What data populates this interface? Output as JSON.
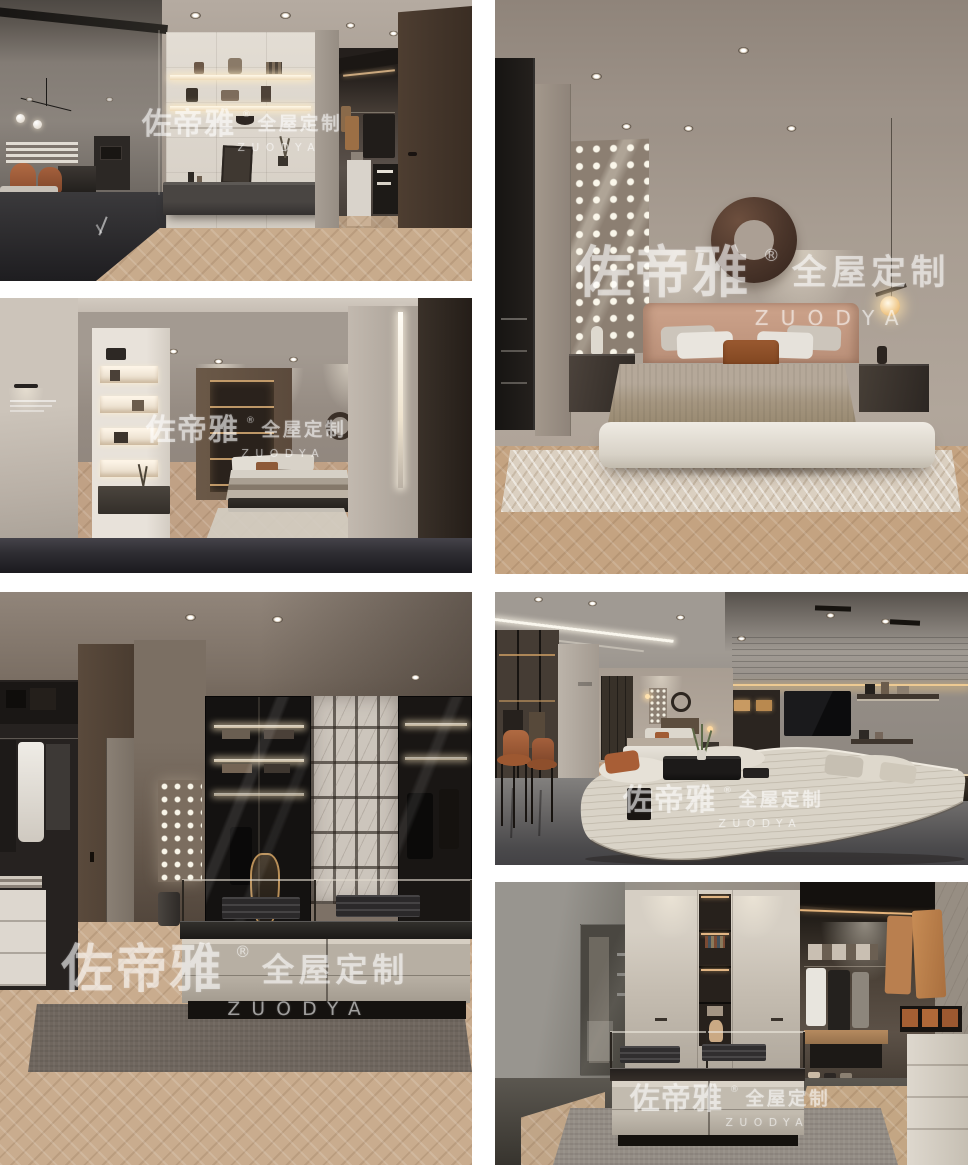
{
  "brand": {
    "name_cn": "佐帝雅",
    "reg_mark": "®",
    "suffix_cn": "全屋定制",
    "name_en": "ZUODYA"
  },
  "colors": {
    "page_background": "#ffffff",
    "wood_floor": "#c9ad8e",
    "dark_wood": "#4a3a2e",
    "accent_rust": "#a65c38",
    "sofa_cream": "#d8d2c6",
    "watermark": "rgba(255,255,255,0.55)"
  }
}
